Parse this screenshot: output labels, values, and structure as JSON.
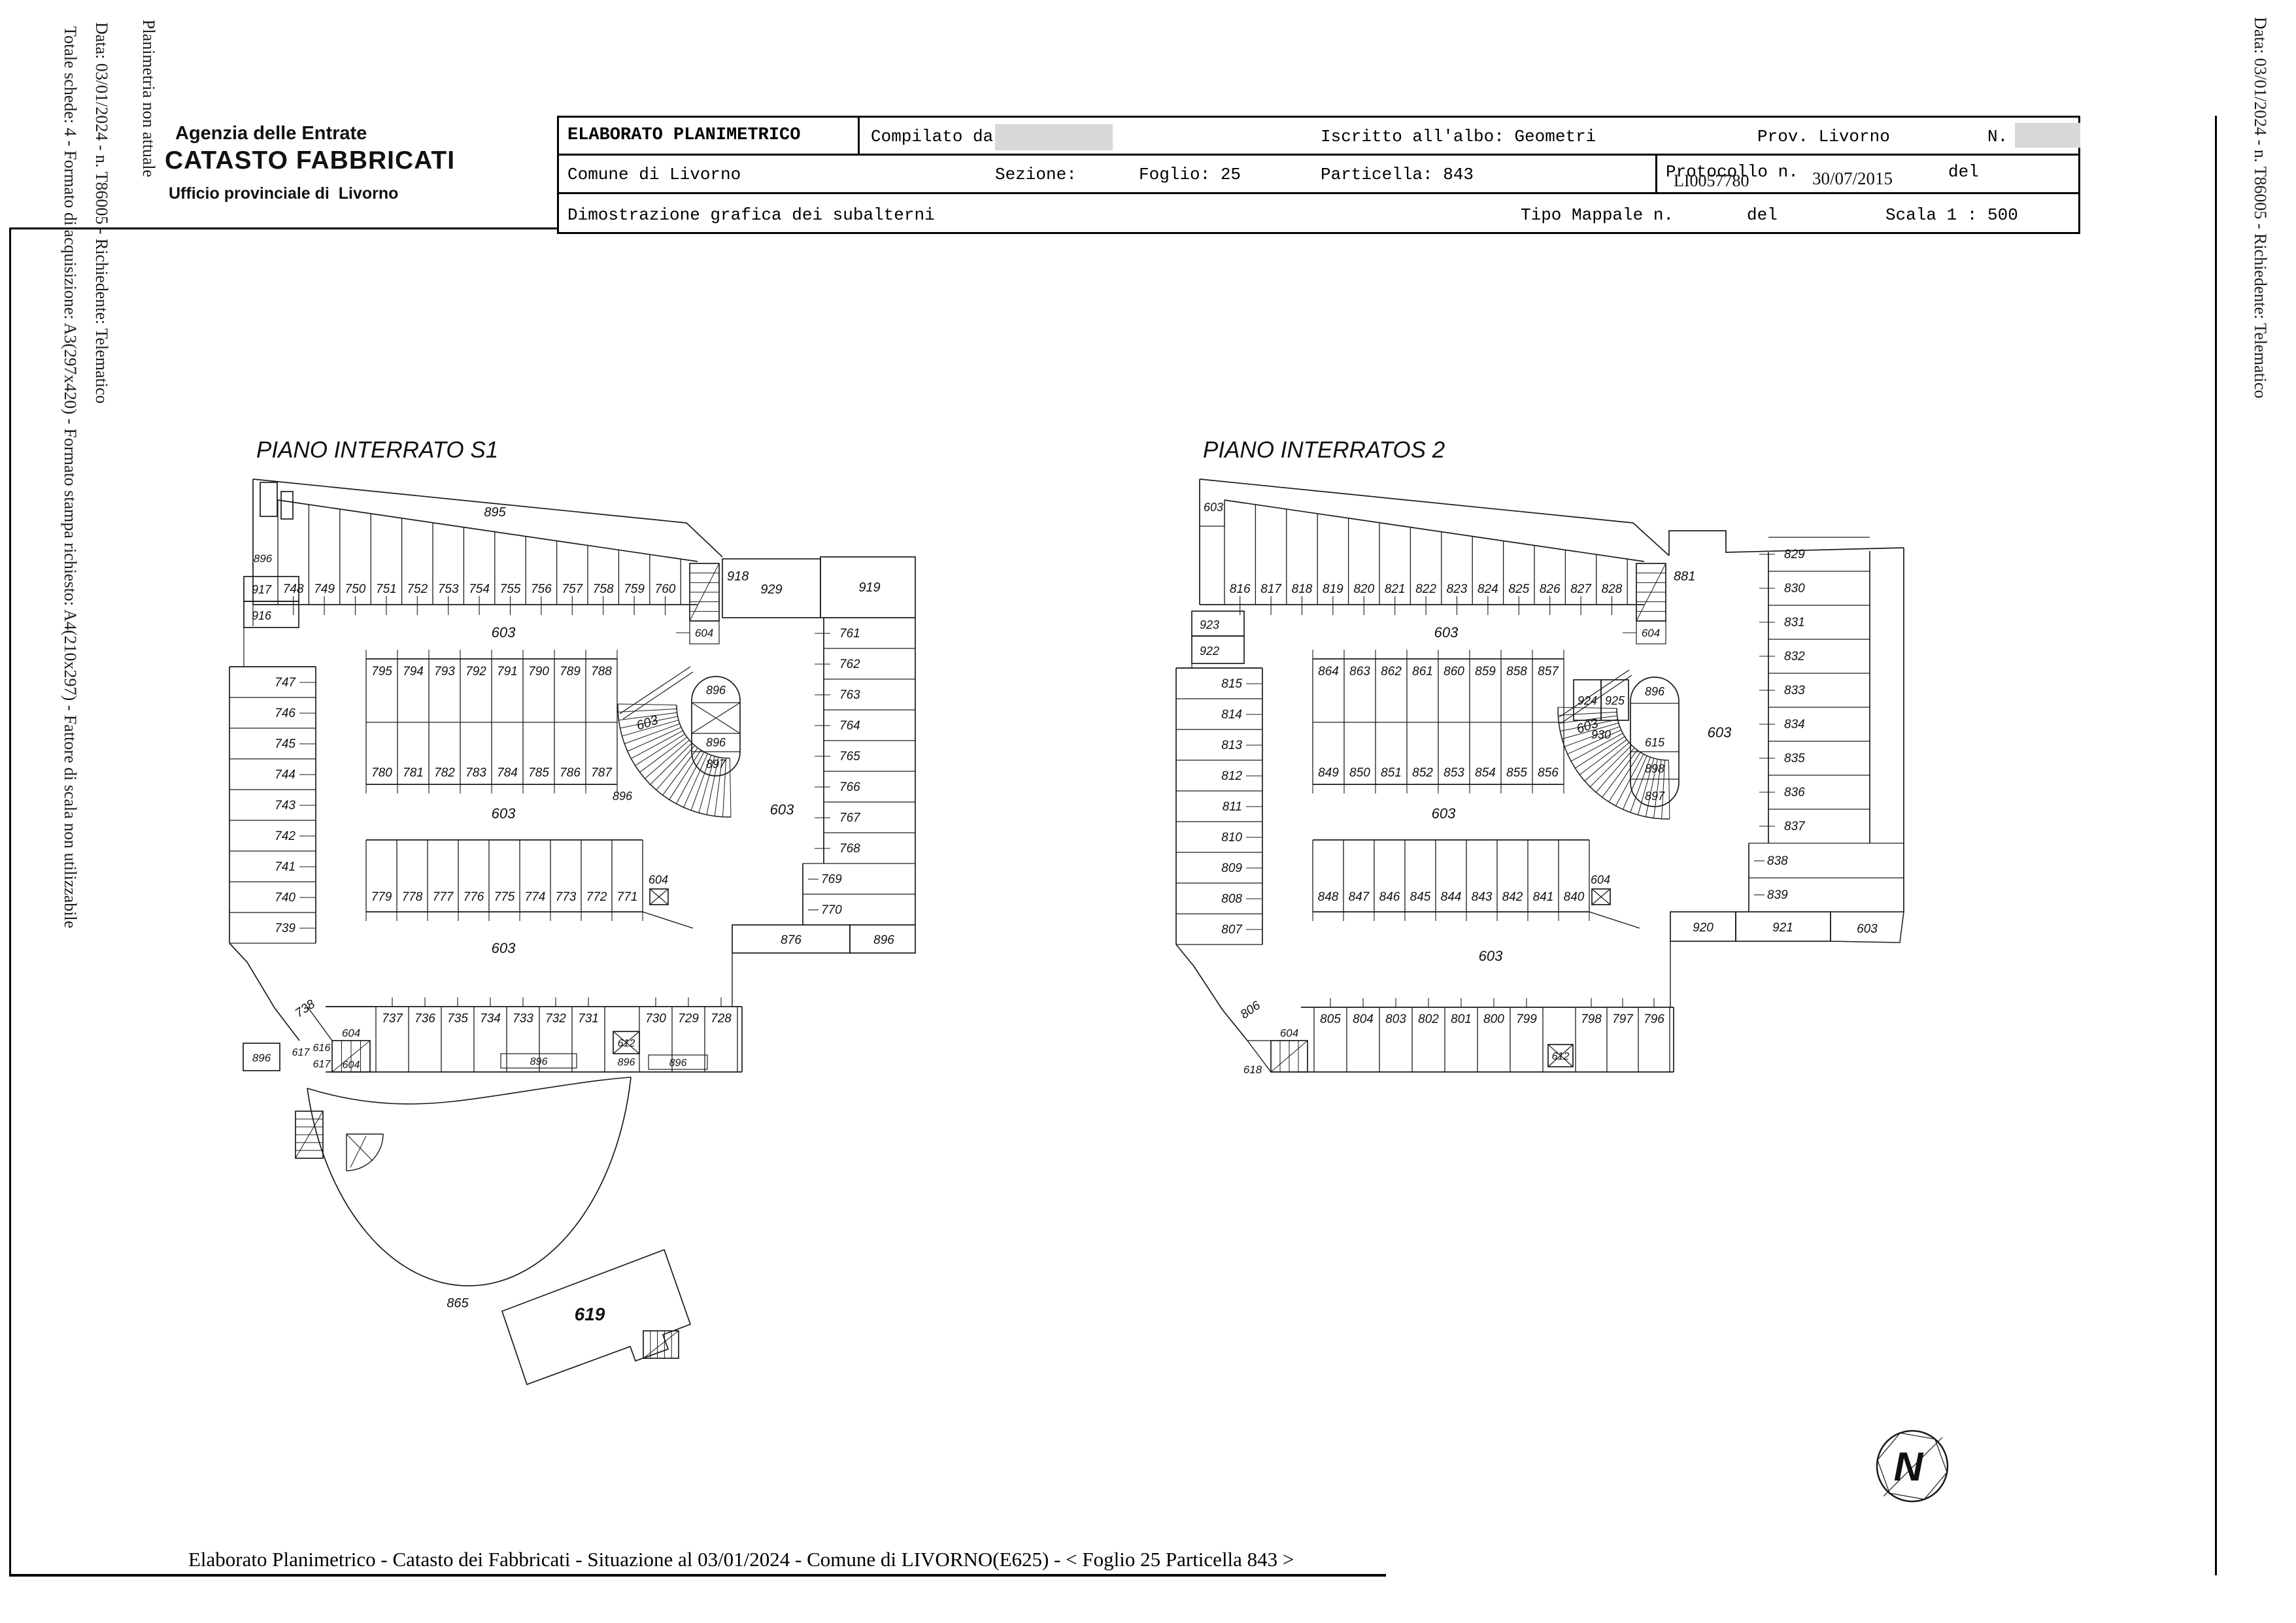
{
  "margins": {
    "left_line1": "Planimetria non attuale",
    "left_line2": "Data: 03/01/2024 - n. T86005 - Richiedente: Telematico",
    "left_line3": "Totale schede: 4 - Formato di acquisizione: A3(297x420) - Formato stampa richiesto: A4(210x297) - Fattore di scala non utilizzabile",
    "right_line1": "Data: 03/01/2024 - n. T86005 - Richiedente: Telematico"
  },
  "logo": {
    "line1": "Agenzia delle Entrate",
    "line2": "CATASTO FABBRICATI",
    "line3_prefix": "Ufficio provinciale di",
    "line3_city": "Livorno"
  },
  "header_table": {
    "title": "ELABORATO PLANIMETRICO",
    "compilato_label": "Compilato da:",
    "iscritto": "Iscritto all'albo: Geometri",
    "prov": "Prov. Livorno",
    "n_label": "N.",
    "comune": "Comune di Livorno",
    "sezione": "Sezione:",
    "foglio": "Foglio: 25",
    "particella": "Particella: 843",
    "protocollo_label": "Protocollo n.",
    "protocollo_value": "LI0057780",
    "protocollo_date": "30/07/2015",
    "del1": "del",
    "dimostrazione": "Dimostrazione grafica dei subalterni",
    "tipo_mappale": "Tipo Mappale n.",
    "del2": "del",
    "scala": "Scala 1 : 500"
  },
  "plans": {
    "s1": {
      "title": "PIANO INTERRATO S1",
      "aisle_label": "895",
      "wall_label_top": "896",
      "top_row": [
        "748",
        "749",
        "750",
        "751",
        "752",
        "753",
        "754",
        "755",
        "756",
        "757",
        "758",
        "759",
        "760"
      ],
      "stair_top_label": "918",
      "stair_top_sub": "604",
      "box_a": "929",
      "box_b": "919",
      "wall_cells": [
        "917",
        "916"
      ],
      "left_col": [
        "747",
        "746",
        "745",
        "744",
        "743",
        "742",
        "741",
        "740",
        "739"
      ],
      "bend_label": "738",
      "right_col": [
        "761",
        "762",
        "763",
        "764",
        "765",
        "766",
        "767",
        "768"
      ],
      "right_inset": [
        "769",
        "770"
      ],
      "corner_boxes": [
        "876",
        "896"
      ],
      "island_top": [
        "795",
        "794",
        "793",
        "792",
        "791",
        "790",
        "789",
        "788"
      ],
      "island_bot": [
        "780",
        "781",
        "782",
        "783",
        "784",
        "785",
        "786",
        "787"
      ],
      "mid_island": [
        "779",
        "778",
        "777",
        "776",
        "775",
        "774",
        "773",
        "772",
        "771"
      ],
      "mid_island_shaft": "604",
      "ramp_label": "603",
      "ramp_side": "896",
      "stadium": [
        "896",
        "896",
        "897"
      ],
      "corridors": [
        "603",
        "603",
        "603"
      ],
      "right_open": "603",
      "bottom_row_a": [
        "737",
        "736",
        "735",
        "734",
        "733",
        "732",
        "731"
      ],
      "bottom_row_b": [
        "730",
        "729",
        "728"
      ],
      "shaft": "612",
      "shaft_sub": "896",
      "bottom_subs": [
        "896",
        "896"
      ],
      "stair_bot": [
        "604",
        "616",
        "617",
        "617",
        "604"
      ],
      "far_left": "896",
      "arc_label": "865",
      "building": "619"
    },
    "s2": {
      "title": "PIANO INTERRATOS 2",
      "corner_label": "603",
      "top_row": [
        "816",
        "817",
        "818",
        "819",
        "820",
        "821",
        "822",
        "823",
        "824",
        "825",
        "826",
        "827",
        "828"
      ],
      "stair_top_label": "881",
      "stair_top_sub": "604",
      "wall_cells": [
        "923",
        "922"
      ],
      "left_col": [
        "815",
        "814",
        "813",
        "812",
        "811",
        "810",
        "809",
        "808",
        "807"
      ],
      "bend_label": "806",
      "right_col": [
        "829",
        "830",
        "831",
        "832",
        "833",
        "834",
        "835",
        "836",
        "837"
      ],
      "right_inset": [
        "838",
        "839"
      ],
      "corner_boxes": [
        "920",
        "921",
        "603"
      ],
      "island_top": [
        "864",
        "863",
        "862",
        "861",
        "860",
        "859",
        "858",
        "857"
      ],
      "island_bot": [
        "849",
        "850",
        "851",
        "852",
        "853",
        "854",
        "855",
        "856"
      ],
      "pair_boxes": [
        "924",
        "925"
      ],
      "pair_sub": "930",
      "mid_island": [
        "848",
        "847",
        "846",
        "845",
        "844",
        "843",
        "842",
        "841",
        "840"
      ],
      "mid_island_shaft": "604",
      "ramp_label": "603",
      "stadium": [
        "896",
        "615",
        "898",
        "897"
      ],
      "corridors": [
        "603",
        "603",
        "603"
      ],
      "right_open": "603",
      "bottom_row_a": [
        "805",
        "804",
        "803",
        "802",
        "801",
        "800",
        "799"
      ],
      "bottom_row_b": [
        "798",
        "797",
        "796"
      ],
      "shaft": "612",
      "stair_bot_label": "604",
      "stair_bot_sub": "618"
    }
  },
  "compass": {
    "letter": "N"
  },
  "footer": {
    "text": "Elaborato Planimetrico - Catasto dei Fabbricati - Situazione al 03/01/2024 - Comune di LIVORNO(E625) - < Foglio 25 Particella 843 >"
  }
}
